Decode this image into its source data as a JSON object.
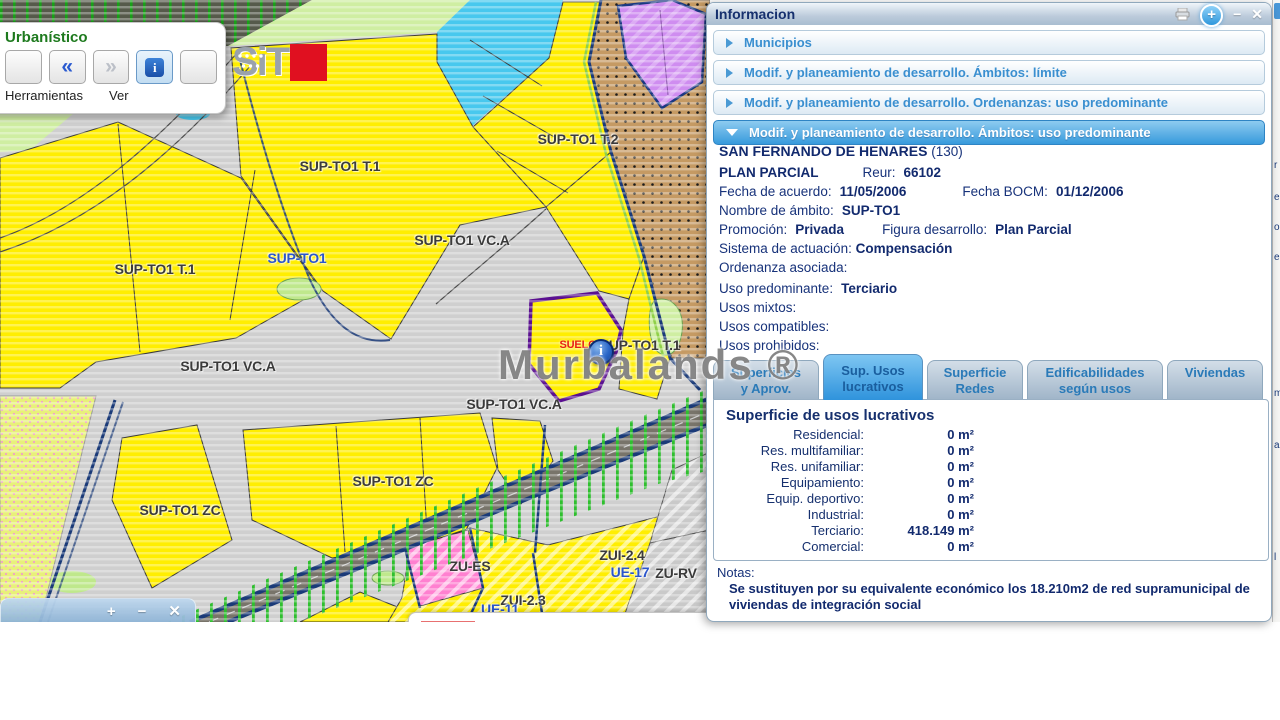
{
  "watermark": "Murbalands ®",
  "map": {
    "toolbar": {
      "title": "Urbanístico",
      "herramientas_label": "Herramientas",
      "ver_label": "Ver",
      "buttons": [
        {
          "name": "zoom-extent-button"
        },
        {
          "name": "previous-button",
          "glyph": "«"
        },
        {
          "name": "next-button",
          "glyph": "»"
        },
        {
          "name": "info-button",
          "glyph": "i"
        },
        {
          "name": "download-button"
        }
      ]
    },
    "logo_text": "SiT",
    "mini_toolbar": {
      "zoom_in": "+",
      "zoom_out": "−",
      "close": "✕"
    },
    "marker_label": "SUELO",
    "labels": [
      {
        "text": "SUP-TO1 T.1",
        "x": 340,
        "y": 166,
        "style": "dark"
      },
      {
        "text": "SUP-TO1 T.2",
        "x": 578,
        "y": 139,
        "style": "dark"
      },
      {
        "text": "SUP-TO1 T.1",
        "x": 155,
        "y": 269,
        "style": "dark"
      },
      {
        "text": "SUP-TO1",
        "x": 297,
        "y": 258,
        "style": "blue"
      },
      {
        "text": "SUP-TO1 VC.A",
        "x": 462,
        "y": 240,
        "style": "dark"
      },
      {
        "text": "SUP-TO1 VC.A",
        "x": 228,
        "y": 366,
        "style": "dark"
      },
      {
        "text": "SUP-TO1 VC.A",
        "x": 514,
        "y": 404,
        "style": "dark"
      },
      {
        "text": "SUP-TO1 T.1",
        "x": 640,
        "y": 345,
        "style": "dark"
      },
      {
        "text": "SUP-TO1 ZC",
        "x": 393,
        "y": 481,
        "style": "dark"
      },
      {
        "text": "SUP-TO1 ZC",
        "x": 180,
        "y": 510,
        "style": "dark"
      },
      {
        "text": "ZUI-2.4",
        "x": 622,
        "y": 555,
        "style": "dark"
      },
      {
        "text": "ZU-ES",
        "x": 470,
        "y": 566,
        "style": "dark"
      },
      {
        "text": "UE-17",
        "x": 630,
        "y": 572,
        "style": "blue"
      },
      {
        "text": "ZU-RV",
        "x": 676,
        "y": 573,
        "style": "dark"
      },
      {
        "text": "ZUI-2.3",
        "x": 523,
        "y": 600,
        "style": "dark"
      },
      {
        "text": "UE-11",
        "x": 500,
        "y": 609,
        "style": "blue"
      },
      {
        "text": "SUELO",
        "x": 578,
        "y": 345,
        "style": "red"
      }
    ]
  },
  "panel": {
    "title": "Informacion",
    "window_controls": {
      "add": "+",
      "minimize": "−",
      "close": "✕"
    },
    "accordion": [
      {
        "label": "Municipios",
        "expanded": false
      },
      {
        "label": "Modif. y planeamiento de desarrollo. Ámbitos: límite",
        "expanded": false
      },
      {
        "label": "Modif. y planeamiento de desarrollo. Ordenanzas: uso predominante",
        "expanded": false
      },
      {
        "label": "Modif. y planeamiento de desarrollo. Ámbitos: uso predominante",
        "expanded": true
      }
    ],
    "details": {
      "municipality": "SAN FERNANDO DE HENARES",
      "municipality_code": "(130)",
      "plan_type": "PLAN PARCIAL",
      "reur_label": "Reur:",
      "reur": "66102",
      "fecha_acuerdo_label": "Fecha de acuerdo:",
      "fecha_acuerdo": "11/05/2006",
      "fecha_bocm_label": "Fecha BOCM:",
      "fecha_bocm": "01/12/2006",
      "nombre_ambito_label": "Nombre de ámbito:",
      "nombre_ambito": "SUP-TO1",
      "promocion_label": "Promoción:",
      "promocion": "Privada",
      "figura_label": "Figura desarrollo:",
      "figura": "Plan Parcial",
      "sistema_label": "Sistema de actuación:",
      "sistema": "Compensación",
      "ordenanza_label": "Ordenanza asociada:",
      "ordenanza": "",
      "uso_predominante_label": "Uso predominante:",
      "uso_predominante": "Terciario",
      "usos_mixtos_label": "Usos mixtos:",
      "usos_mixtos": "",
      "usos_compatibles_label": "Usos compatibles:",
      "usos_compatibles": "",
      "usos_prohibidos_label": "Usos prohibidos:",
      "usos_prohibidos": ""
    },
    "tabs": [
      {
        "line1": "Superficies",
        "line2": "y Aprov.",
        "active": false,
        "width": 106
      },
      {
        "line1": "Sup. Usos",
        "line2": "lucrativos",
        "active": true,
        "width": 100
      },
      {
        "line1": "Superficie",
        "line2": "Redes",
        "active": false,
        "width": 96
      },
      {
        "line1": "Edificabilidades",
        "line2": "según usos",
        "active": false,
        "width": 136
      },
      {
        "line1": "Viviendas",
        "line2": "",
        "active": false,
        "width": 96
      }
    ],
    "table": {
      "title": "Superficie de usos lucrativos",
      "rows": [
        {
          "label": "Residencial:",
          "value": "0 m²"
        },
        {
          "label": "Res. multifamiliar:",
          "value": "0 m²"
        },
        {
          "label": "Res. unifamiliar:",
          "value": "0 m²"
        },
        {
          "label": "Equipamiento:",
          "value": "0 m²"
        },
        {
          "label": "Equip. deportivo:",
          "value": "0 m²"
        },
        {
          "label": "Industrial:",
          "value": "0 m²"
        },
        {
          "label": "Terciario:",
          "value": "418.149 m²"
        },
        {
          "label": "Comercial:",
          "value": "0 m²"
        }
      ]
    },
    "notes_label": "Notas:",
    "notes_text": "Se sustituyen por su equivalente económico los 18.210m2 de red supramunicipal de viviendas de integración social"
  },
  "sliver": {
    "letters": [
      {
        "ch": "r",
        "y": 160
      },
      {
        "ch": "e",
        "y": 192
      },
      {
        "ch": "o",
        "y": 222
      },
      {
        "ch": "e",
        "y": 252
      },
      {
        "ch": "m",
        "y": 388
      },
      {
        "ch": "a",
        "y": 440
      },
      {
        "ch": "l",
        "y": 552
      }
    ]
  },
  "colors": {
    "zone_yellow": "#ffee00",
    "zone_cyan": "#48c8ee",
    "zone_tan": "#c59a63",
    "zone_purple": "#cf8df0",
    "zone_pink": "#ff80d0",
    "boundary_navy": "#1a3a78",
    "selected_outline": "#5a1090",
    "accent_blue": "#379adc"
  }
}
